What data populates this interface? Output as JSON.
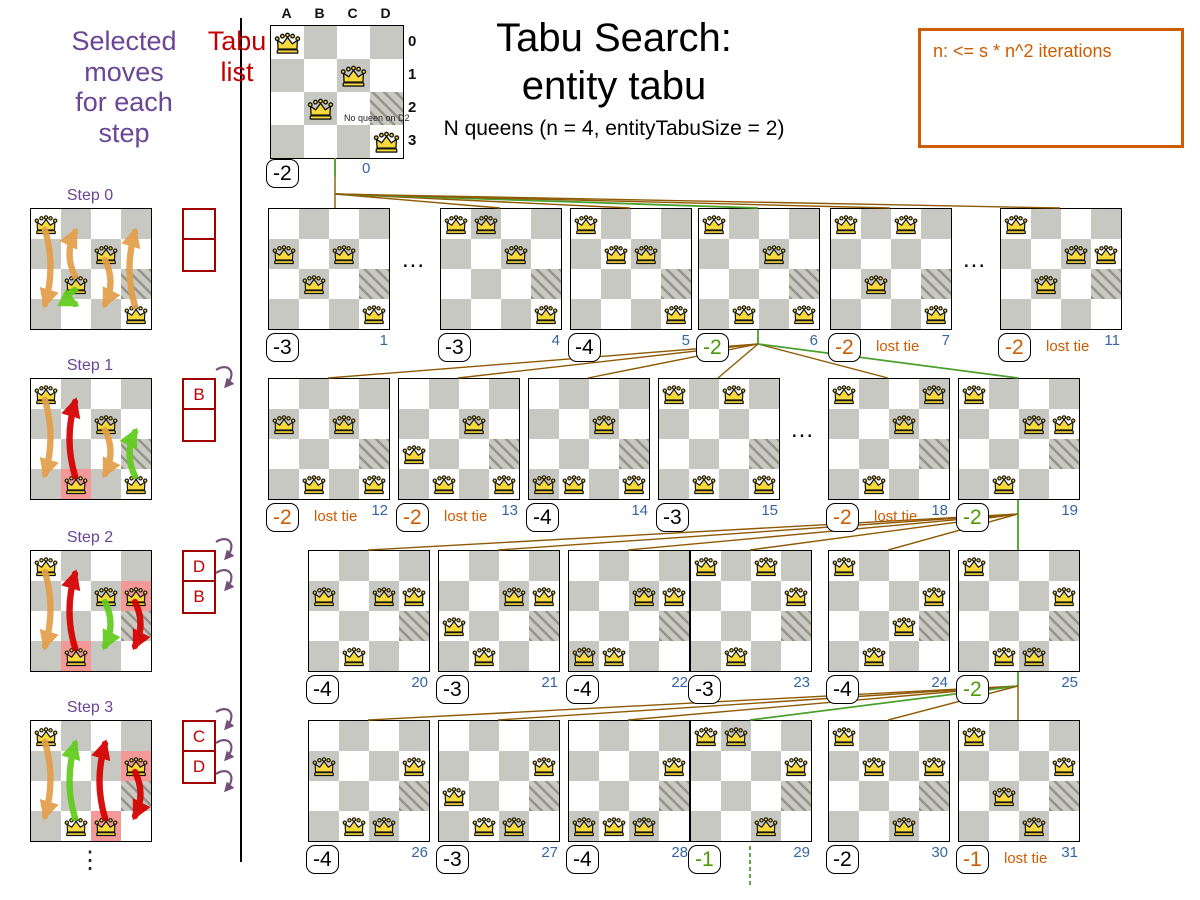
{
  "header": {
    "selected_moves_lines": [
      "Selected",
      "moves",
      "for each",
      "step"
    ],
    "tabu_list_lines": [
      "Tabu",
      "list"
    ],
    "ellipsis": "⋮"
  },
  "title": {
    "line1": "Tabu Search:",
    "line2": "entity tabu",
    "subtitle": "N queens (n = 4, entityTabuSize = 2)"
  },
  "info_box": {
    "text": "n: <= s * n^2 iterations"
  },
  "labels": {
    "lost_tie": "lost tie",
    "dots": "..."
  },
  "top_board": {
    "col_headers": [
      "A",
      "B",
      "C",
      "D"
    ],
    "row_headers": [
      "0",
      "1",
      "2",
      "3"
    ],
    "annotation": "No queen on D2",
    "queens": [
      "A0",
      "C1",
      "B2",
      "D3"
    ],
    "score": "-2",
    "score_color": "black",
    "index": "0"
  },
  "board_defaults": {
    "hatched": [
      "D2"
    ]
  },
  "steps": [
    {
      "label": "Step 0",
      "queens": [
        "A0",
        "C1",
        "B2",
        "D3"
      ],
      "highlight": [],
      "tabu": [
        "",
        ""
      ],
      "curls": 0,
      "arrows": [
        {
          "col": "A",
          "from": 0,
          "to": 3,
          "color": "orange"
        },
        {
          "col": "B",
          "from": 2,
          "to": 0,
          "color": "orange"
        },
        {
          "col": "B",
          "from": 2,
          "to": 3,
          "color": "green"
        },
        {
          "col": "C",
          "from": 1,
          "to": 3,
          "color": "orange"
        },
        {
          "col": "D",
          "from": 3,
          "to": 0,
          "color": "orange"
        }
      ]
    },
    {
      "label": "Step 1",
      "queens": [
        "A0",
        "C1",
        "B3",
        "D3"
      ],
      "highlight": [
        "B3"
      ],
      "tabu": [
        "B",
        ""
      ],
      "curls": 1,
      "arrows": [
        {
          "col": "A",
          "from": 0,
          "to": 3,
          "color": "orange"
        },
        {
          "col": "B",
          "from": 3,
          "to": 0,
          "color": "red"
        },
        {
          "col": "C",
          "from": 1,
          "to": 3,
          "color": "orange"
        },
        {
          "col": "D",
          "from": 3,
          "to": 1,
          "color": "green"
        }
      ]
    },
    {
      "label": "Step 2",
      "queens": [
        "A0",
        "C1",
        "D1",
        "B3"
      ],
      "highlight": [
        "D1",
        "B3"
      ],
      "tabu": [
        "D",
        "B"
      ],
      "curls": 2,
      "arrows": [
        {
          "col": "A",
          "from": 0,
          "to": 3,
          "color": "orange"
        },
        {
          "col": "B",
          "from": 3,
          "to": 0,
          "color": "red"
        },
        {
          "col": "C",
          "from": 1,
          "to": 3,
          "color": "green"
        },
        {
          "col": "D",
          "from": 1,
          "to": 3,
          "color": "red"
        }
      ]
    },
    {
      "label": "Step 3",
      "queens": [
        "A0",
        "D1",
        "B3",
        "C3"
      ],
      "highlight": [
        "D1",
        "C3"
      ],
      "tabu": [
        "C",
        "D"
      ],
      "curls": 3,
      "arrows": [
        {
          "col": "A",
          "from": 0,
          "to": 3,
          "color": "orange"
        },
        {
          "col": "B",
          "from": 3,
          "to": 0,
          "color": "green"
        },
        {
          "col": "C",
          "from": 3,
          "to": 0,
          "color": "red"
        },
        {
          "col": "D",
          "from": 1,
          "to": 3,
          "color": "red"
        }
      ]
    }
  ],
  "search_rows": [
    {
      "row": 1,
      "boards": [
        {
          "id": 1,
          "slot": 0,
          "queens": [
            "A1",
            "C1",
            "B2",
            "D3"
          ],
          "score": "-3",
          "score_color": "black",
          "lost_tie": false,
          "index": "1"
        },
        {
          "id": 4,
          "slot": 1,
          "queens": [
            "A0",
            "B0",
            "C1",
            "D3"
          ],
          "score": "-3",
          "score_color": "black",
          "lost_tie": false,
          "index": "4"
        },
        {
          "id": 5,
          "slot": 2,
          "queens": [
            "A0",
            "B1",
            "C1",
            "D3"
          ],
          "score": "-4",
          "score_color": "black",
          "lost_tie": false,
          "index": "5"
        },
        {
          "id": 6,
          "slot": 3,
          "queens": [
            "A0",
            "C1",
            "B3",
            "D3"
          ],
          "score": "-2",
          "score_color": "green",
          "lost_tie": false,
          "index": "6"
        },
        {
          "id": 7,
          "slot": 4,
          "queens": [
            "A0",
            "C0",
            "B2",
            "D3"
          ],
          "score": "-2",
          "score_color": "orange",
          "lost_tie": true,
          "index": "7"
        },
        {
          "id": 11,
          "slot": 5,
          "queens": [
            "A0",
            "C1",
            "D1",
            "B2"
          ],
          "score": "-2",
          "score_color": "orange",
          "lost_tie": true,
          "index": "11"
        }
      ]
    },
    {
      "row": 2,
      "boards": [
        {
          "id": 12,
          "slot": 0,
          "queens": [
            "A1",
            "C1",
            "B3",
            "D3"
          ],
          "score": "-2",
          "score_color": "orange",
          "lost_tie": true,
          "index": "12"
        },
        {
          "id": 13,
          "slot": 1,
          "queens": [
            "C1",
            "A2",
            "B3",
            "D3"
          ],
          "score": "-2",
          "score_color": "orange",
          "lost_tie": true,
          "index": "13"
        },
        {
          "id": 14,
          "slot": 2,
          "queens": [
            "C1",
            "A3",
            "B3",
            "D3"
          ],
          "score": "-4",
          "score_color": "black",
          "lost_tie": false,
          "index": "14"
        },
        {
          "id": 15,
          "slot": 3,
          "queens": [
            "A0",
            "C0",
            "B3",
            "D3"
          ],
          "score": "-3",
          "score_color": "black",
          "lost_tie": false,
          "index": "15"
        },
        {
          "id": 18,
          "slot": 4,
          "queens": [
            "A0",
            "D0",
            "C1",
            "B3"
          ],
          "score": "-2",
          "score_color": "orange",
          "lost_tie": true,
          "index": "18"
        },
        {
          "id": 19,
          "slot": 5,
          "queens": [
            "A0",
            "C1",
            "D1",
            "B3"
          ],
          "score": "-2",
          "score_color": "green",
          "lost_tie": false,
          "index": "19"
        }
      ]
    },
    {
      "row": 3,
      "boards": [
        {
          "id": 20,
          "slot": 0,
          "queens": [
            "A1",
            "C1",
            "D1",
            "B3"
          ],
          "score": "-4",
          "score_color": "black",
          "lost_tie": false,
          "index": "20"
        },
        {
          "id": 21,
          "slot": 1,
          "queens": [
            "C1",
            "D1",
            "A2",
            "B3"
          ],
          "score": "-3",
          "score_color": "black",
          "lost_tie": false,
          "index": "21"
        },
        {
          "id": 22,
          "slot": 2,
          "queens": [
            "C1",
            "D1",
            "A3",
            "B3"
          ],
          "score": "-4",
          "score_color": "black",
          "lost_tie": false,
          "index": "22"
        },
        {
          "id": 23,
          "slot": 3,
          "queens": [
            "A0",
            "C0",
            "D1",
            "B3"
          ],
          "score": "-3",
          "score_color": "black",
          "lost_tie": false,
          "index": "23"
        },
        {
          "id": 24,
          "slot": 4,
          "queens": [
            "A0",
            "D1",
            "C2",
            "B3"
          ],
          "score": "-4",
          "score_color": "black",
          "lost_tie": false,
          "index": "24"
        },
        {
          "id": 25,
          "slot": 5,
          "queens": [
            "A0",
            "D1",
            "B3",
            "C3"
          ],
          "score": "-2",
          "score_color": "green",
          "lost_tie": false,
          "index": "25"
        }
      ]
    },
    {
      "row": 4,
      "boards": [
        {
          "id": 26,
          "slot": 0,
          "queens": [
            "A1",
            "D1",
            "B3",
            "C3"
          ],
          "score": "-4",
          "score_color": "black",
          "lost_tie": false,
          "index": "26"
        },
        {
          "id": 27,
          "slot": 1,
          "queens": [
            "D1",
            "A2",
            "B3",
            "C3"
          ],
          "score": "-3",
          "score_color": "black",
          "lost_tie": false,
          "index": "27"
        },
        {
          "id": 28,
          "slot": 2,
          "queens": [
            "D1",
            "A3",
            "B3",
            "C3"
          ],
          "score": "-4",
          "score_color": "black",
          "lost_tie": false,
          "index": "28"
        },
        {
          "id": 29,
          "slot": 3,
          "queens": [
            "A0",
            "B0",
            "D1",
            "C3"
          ],
          "score": "-1",
          "score_color": "green",
          "lost_tie": false,
          "index": "29"
        },
        {
          "id": 30,
          "slot": 4,
          "queens": [
            "A0",
            "B1",
            "D1",
            "C3"
          ],
          "score": "-2",
          "score_color": "black",
          "lost_tie": false,
          "index": "30"
        },
        {
          "id": 31,
          "slot": 5,
          "queens": [
            "A0",
            "B2",
            "D1",
            "C3"
          ],
          "score": "-1",
          "score_color": "orange",
          "lost_tie": true,
          "index": "31"
        }
      ]
    }
  ],
  "gap_dots": [
    {
      "row": 1,
      "left": 1,
      "right": 4
    },
    {
      "row": 1,
      "left": 7,
      "right": 11
    },
    {
      "row": 2,
      "left": 15,
      "right": 18
    }
  ],
  "connections": [
    {
      "from": "root",
      "children": [
        1,
        4,
        5,
        6,
        7,
        11
      ],
      "winner": 6
    },
    {
      "from": 6,
      "children": [
        12,
        13,
        14,
        15,
        18,
        19
      ],
      "winner": 19
    },
    {
      "from": 19,
      "children": [
        20,
        21,
        22,
        23,
        24,
        25
      ],
      "winner": 25
    },
    {
      "from": 25,
      "children": [
        26,
        27,
        28,
        29,
        30,
        31
      ],
      "winner": 29
    }
  ],
  "continuation_board": 29,
  "colors": {
    "purple": "#6b4596",
    "tabu_red": "#a40000",
    "tabu_letter": "#c00000",
    "score_orange": "#ce5c00",
    "score_green": "#4e9a06",
    "index_blue": "#3465a4",
    "line_brown": "#8f5902",
    "line_green": "#4aa02c",
    "cell_dark": "#c8c8c3",
    "highlight": "#f59898",
    "queen_gold": "#f8d93c",
    "arrow_orange": "#e2a04a",
    "arrow_red": "#d40000",
    "arrow_green": "#62cc1d",
    "curl_purple": "#75507b",
    "info_orange": "#ce5c00"
  }
}
